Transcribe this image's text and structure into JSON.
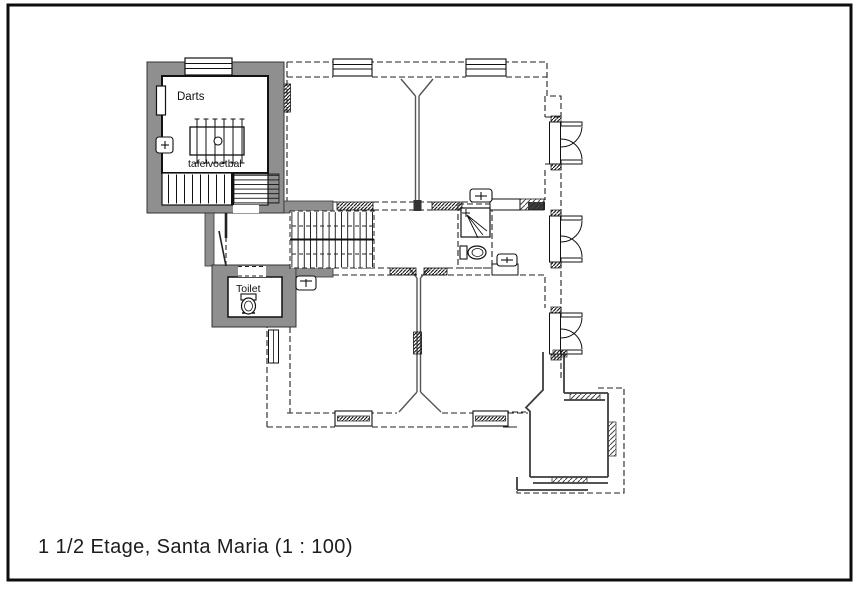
{
  "caption": "1 1/2 Etage, Santa Maria (1 : 100)",
  "drawing": {
    "type": "floor-plan",
    "floor": "1 1/2 Etage",
    "building": "Santa Maria",
    "scale": "1 : 100"
  },
  "rooms": {
    "darts": "Darts",
    "table_football": "tafelvoetbal",
    "toilet": "Toilet"
  },
  "fixtures": [
    "toilet",
    "toilet",
    "shower",
    "sink",
    "sink",
    "sink",
    "sink",
    "table-football",
    "stairs",
    "stairs"
  ],
  "colors": {
    "wall_fill": "#8f8f8f",
    "line": "#1a1a1a",
    "dashed_line": "#222222",
    "background": "#ffffff"
  }
}
